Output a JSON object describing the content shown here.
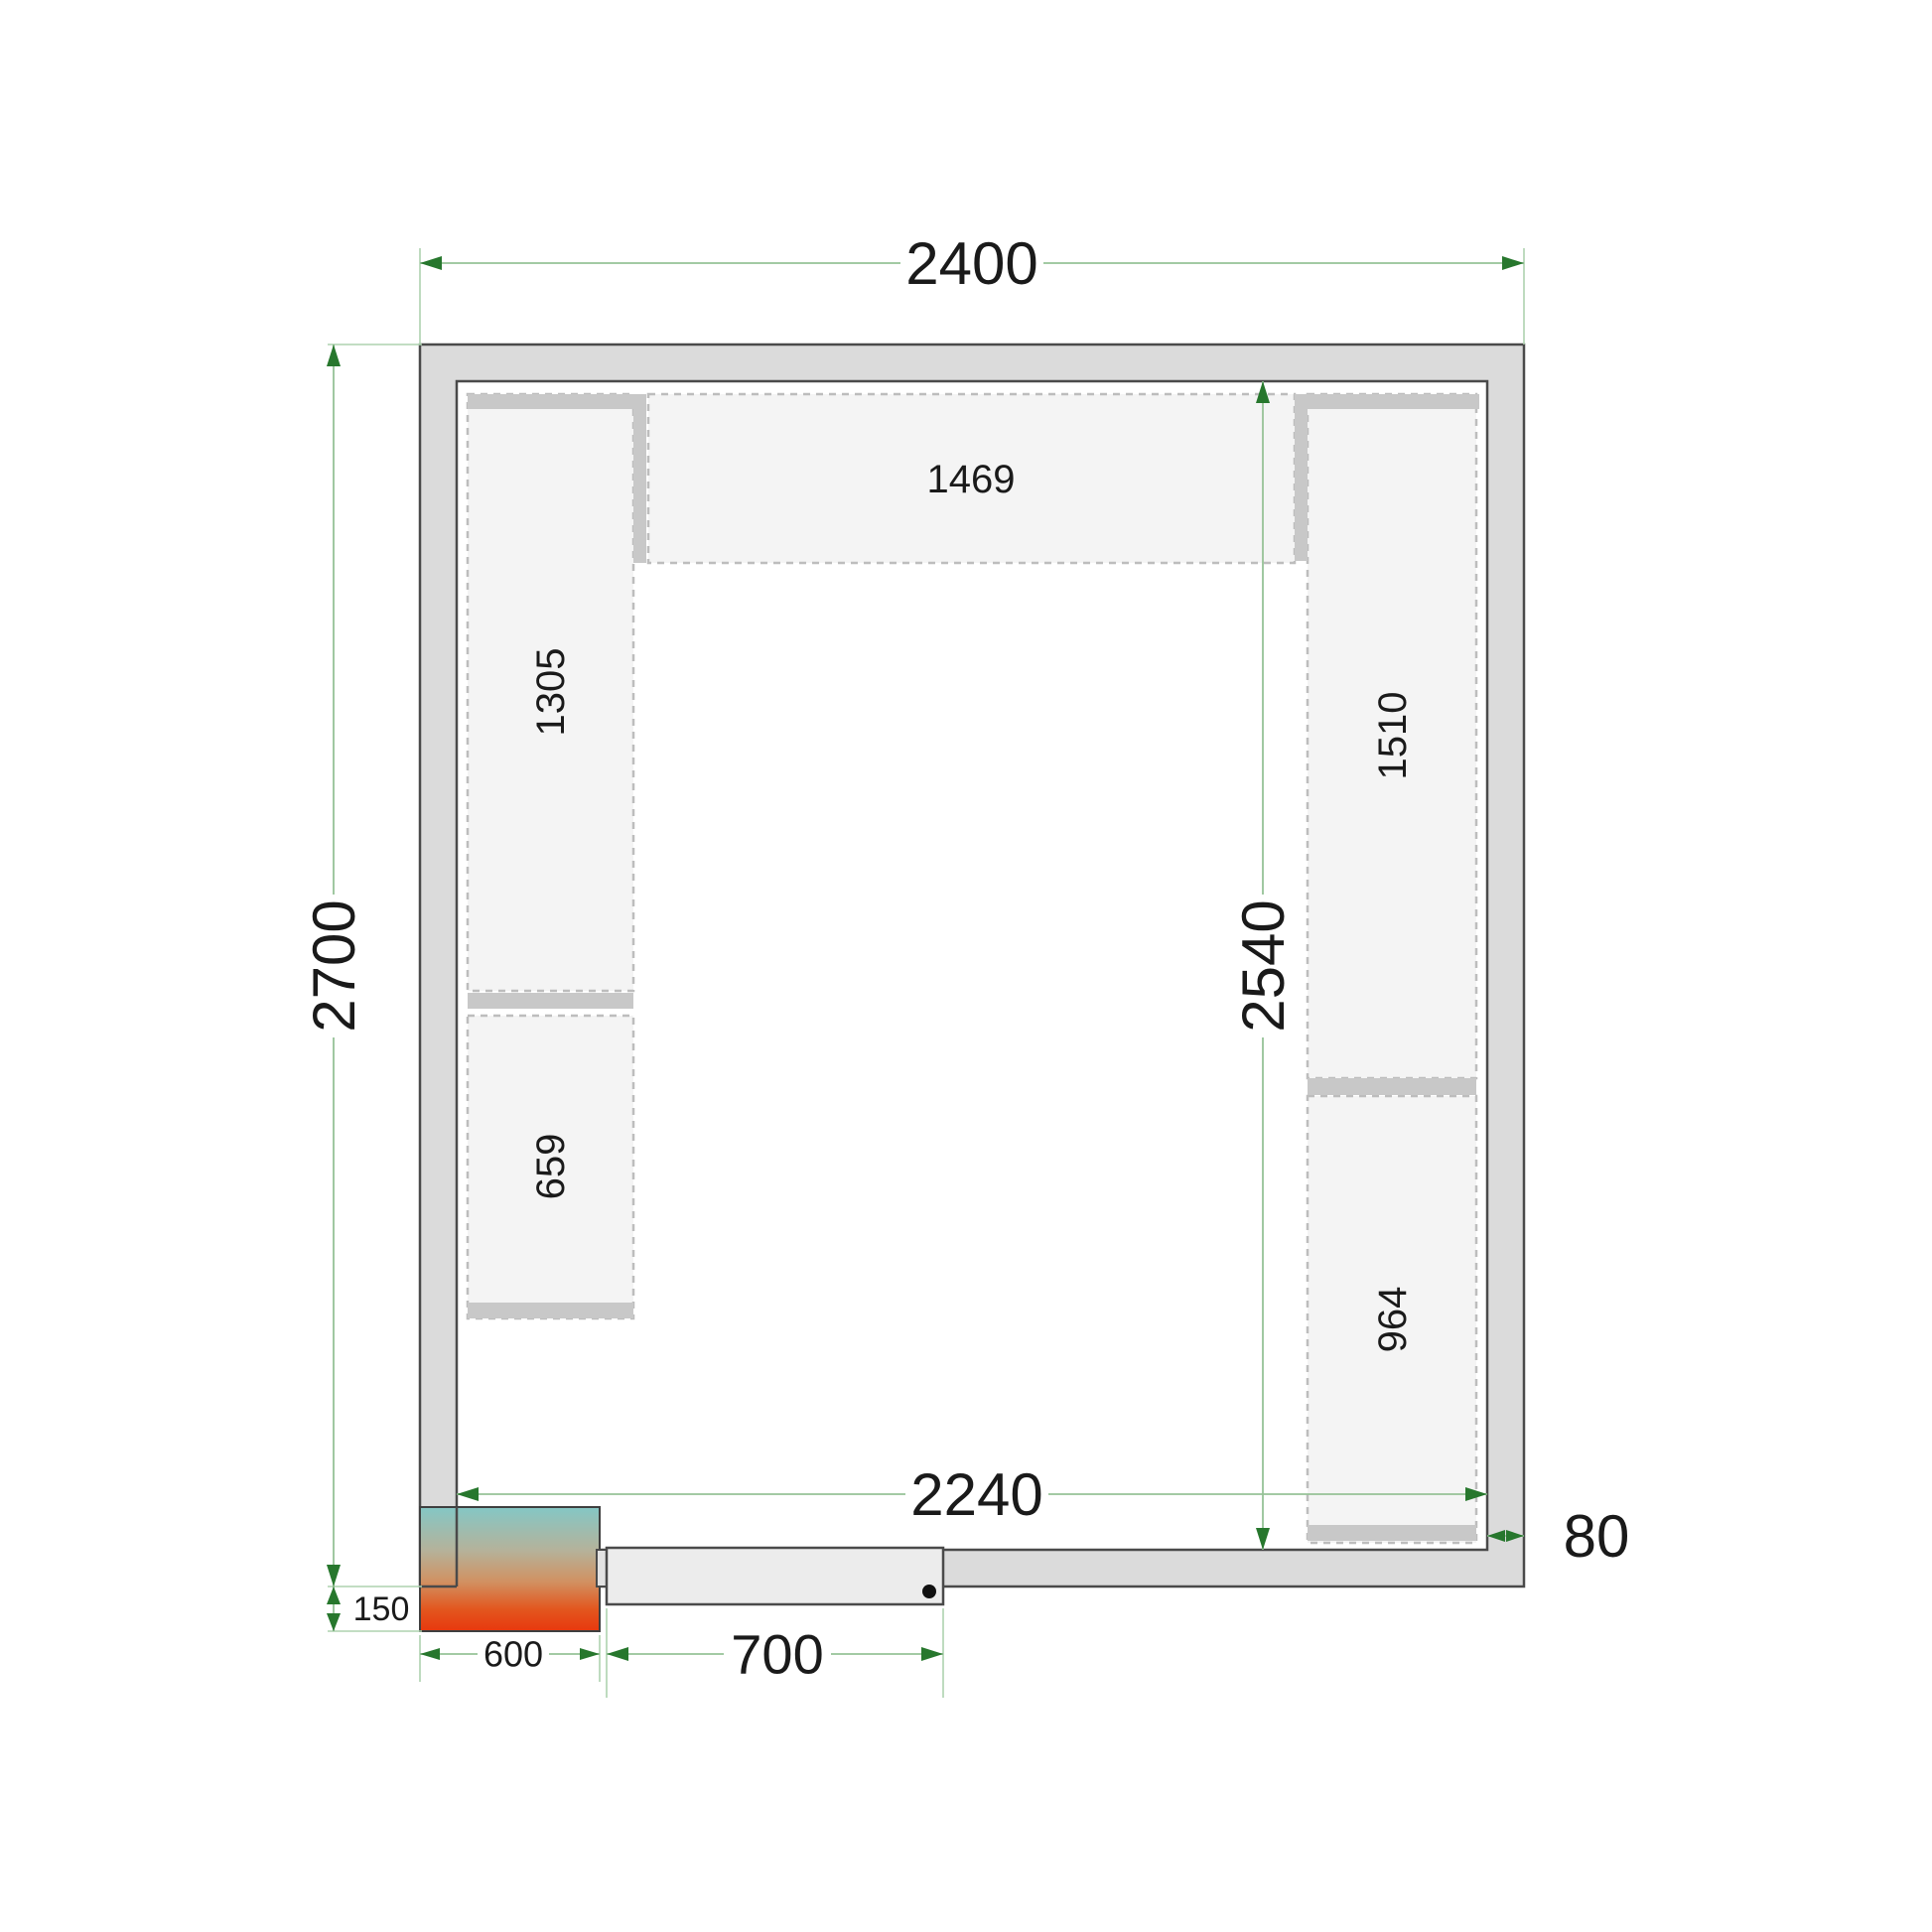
{
  "figure": {
    "kind": "cold-room floor plan technical drawing",
    "units": "mm"
  },
  "dimensions": {
    "outer_width": "2400",
    "outer_height": "2700",
    "inner_width": "2240",
    "inner_height": "2540",
    "wall_thickness": "80",
    "door_width": "700",
    "unit_width": "600",
    "unit_overhang": "150"
  },
  "shelves": {
    "top": "1469",
    "left_upper": "1305",
    "left_lower": "659",
    "right_upper": "1510",
    "right_lower": "964"
  },
  "colors": {
    "wall_fill": "#dbdbdb",
    "shelf_fill": "#f4f4f4",
    "support_bar_fill": "#c8c8c8",
    "dimension_line": "#96c297",
    "extension_line": "#aed2af",
    "arrow": "#27772d",
    "text": "#1a1a1a",
    "unit_gradient_top": "#84c7c5",
    "unit_gradient_mid": "#d19162",
    "unit_gradient_bottom": "#e8380e"
  }
}
